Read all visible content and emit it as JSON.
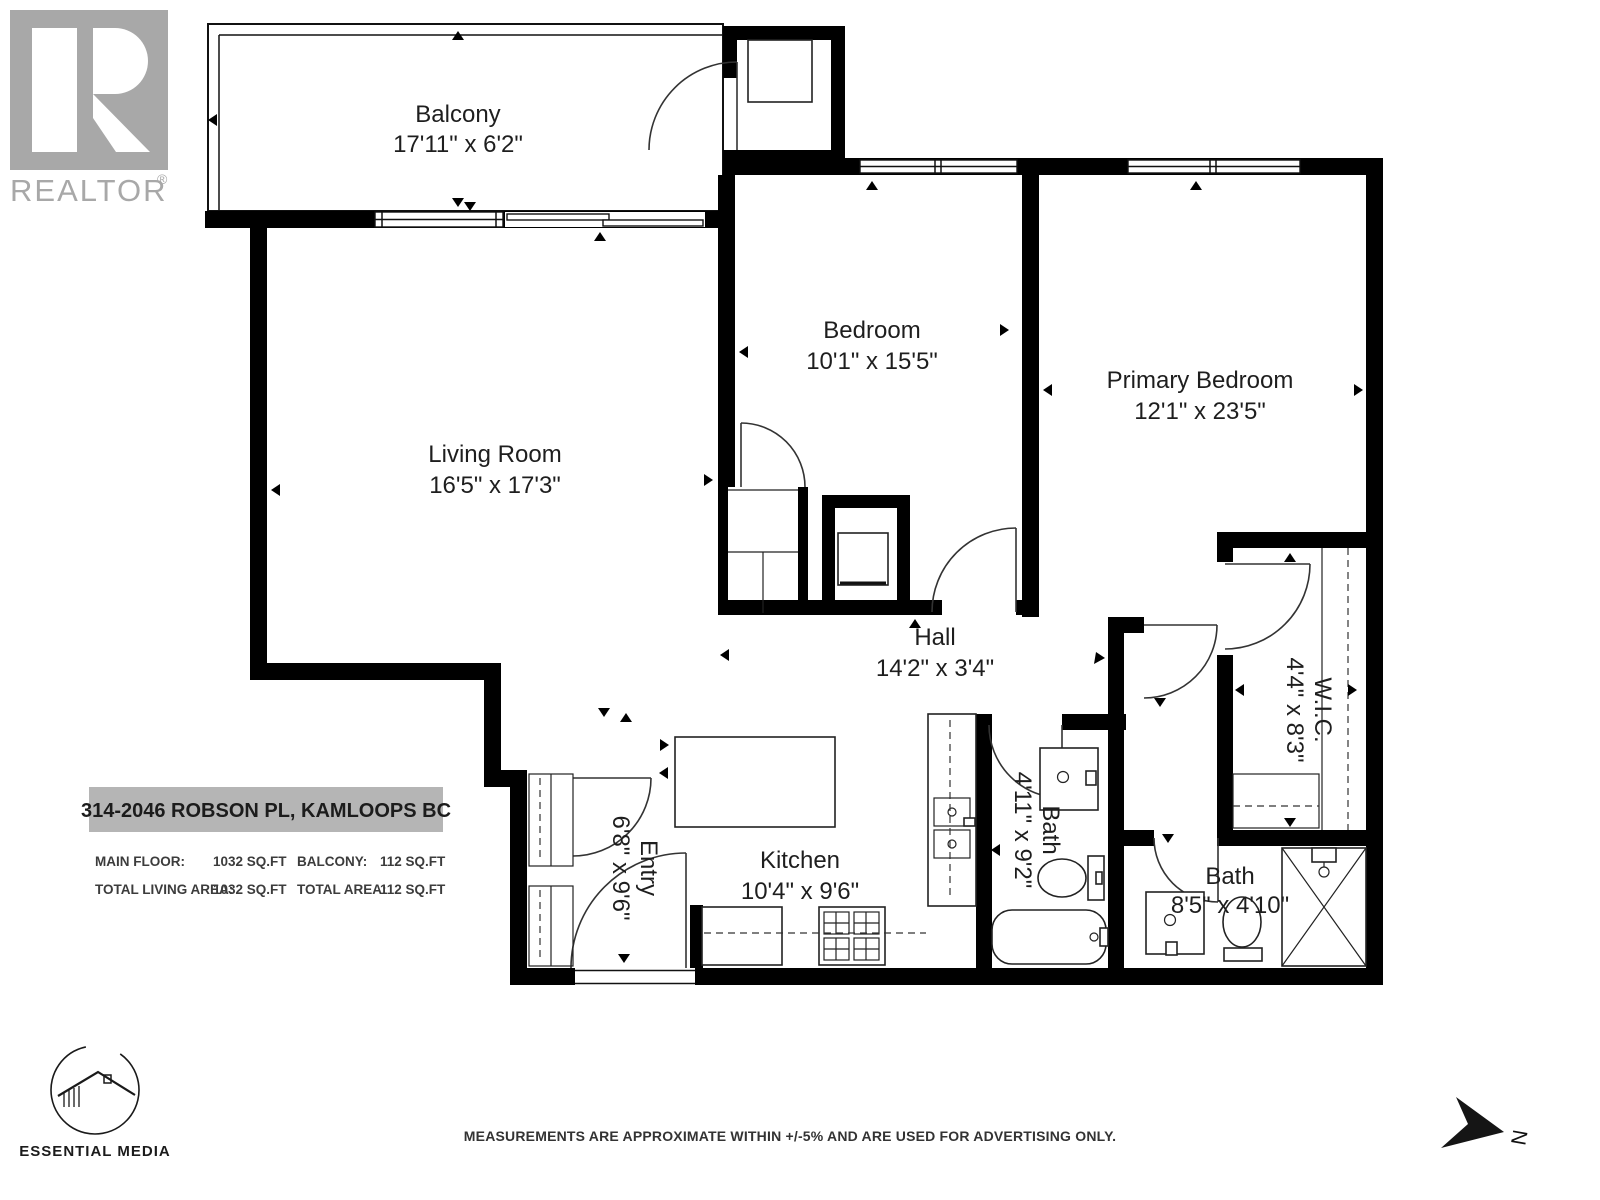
{
  "branding": {
    "realtor_word": "REALTOR",
    "registered": "®",
    "media_word": "ESSENTIAL MEDIA"
  },
  "address": {
    "title": "314-2046 ROBSON PL, KAMLOOPS BC",
    "areas": {
      "col1": [
        {
          "label": "MAIN FLOOR:",
          "value": "1032 SQ.FT"
        },
        {
          "label": "TOTAL LIVING AREA:",
          "value": "1032 SQ.FT"
        }
      ],
      "col2": [
        {
          "label": "BALCONY:",
          "value": "112 SQ.FT"
        },
        {
          "label": "TOTAL AREA:",
          "value": "112 SQ.FT"
        }
      ]
    }
  },
  "rooms": {
    "balcony": {
      "name": "Balcony",
      "dims": "17'11\" x 6'2\""
    },
    "bedroom": {
      "name": "Bedroom",
      "dims": "10'1\" x 15'5\""
    },
    "primary": {
      "name": "Primary Bedroom",
      "dims": "12'1\" x 23'5\""
    },
    "living": {
      "name": "Living Room",
      "dims": "16'5\" x 17'3\""
    },
    "hall": {
      "name": "Hall",
      "dims": "14'2\" x 3'4\""
    },
    "wic": {
      "name": "W.I.C.",
      "dims": "4'4\" x 8'3\""
    },
    "bath1": {
      "name": "Bath",
      "dims": "4'11\" x 9'2\""
    },
    "bath2": {
      "name": "Bath",
      "dims": "8'5\" x 4'10\""
    },
    "kitchen": {
      "name": "Kitchen",
      "dims": "10'4\" x 9'6\""
    },
    "entry": {
      "name": "Entry",
      "dims": "6'8\" x 9'6\""
    }
  },
  "footer": {
    "disclaimer": "MEASUREMENTS ARE APPROXIMATE WITHIN +/-5% AND ARE USED FOR ADVERTISING ONLY."
  },
  "compass": {
    "label": "N"
  }
}
